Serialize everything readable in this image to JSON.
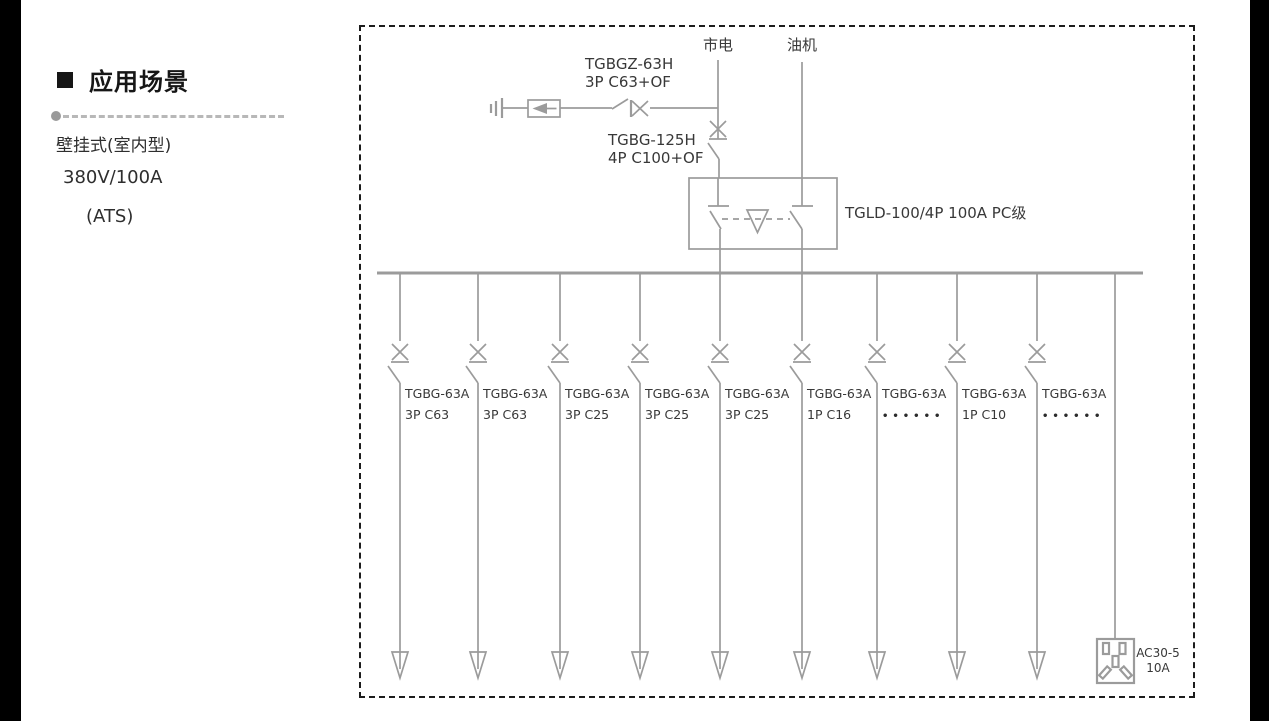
{
  "colors": {
    "line_gray": "#9b9b9b",
    "text_dark": "#383838",
    "frame_border": "#1c1c1c",
    "edge_bar": "#000000"
  },
  "sidebar": {
    "section_title": "应用场景",
    "lines": [
      "壁挂式(室内型)",
      "380V/100A",
      "(ATS)"
    ]
  },
  "diagram": {
    "source_labels": {
      "mains": "市电",
      "generator": "油机"
    },
    "spd_breaker": {
      "model": "TGBGZ-63H",
      "spec": "3P C63+OF"
    },
    "main_breaker": {
      "model": "TGBG-125H",
      "spec": "4P C100+OF"
    },
    "ats": {
      "label": "TGLD-100/4P 100A PC级"
    },
    "branches": [
      {
        "model": "TGBG-63A",
        "spec": "3P C63",
        "x": 400
      },
      {
        "model": "TGBG-63A",
        "spec": "3P C63",
        "x": 478
      },
      {
        "model": "TGBG-63A",
        "spec": "3P C25",
        "x": 560
      },
      {
        "model": "TGBG-63A",
        "spec": "3P C25",
        "x": 640
      },
      {
        "model": "TGBG-63A",
        "spec": "3P C25",
        "x": 720
      },
      {
        "model": "TGBG-63A",
        "spec": "1P C16",
        "x": 802
      },
      {
        "model": "TGBG-63A",
        "spec": "••••••",
        "x": 877
      },
      {
        "model": "TGBG-63A",
        "spec": "1P C10",
        "x": 957
      },
      {
        "model": "TGBG-63A",
        "spec": "••••••",
        "x": 1037
      }
    ],
    "socket": {
      "model": "AC30-5",
      "rating": "10A"
    }
  }
}
